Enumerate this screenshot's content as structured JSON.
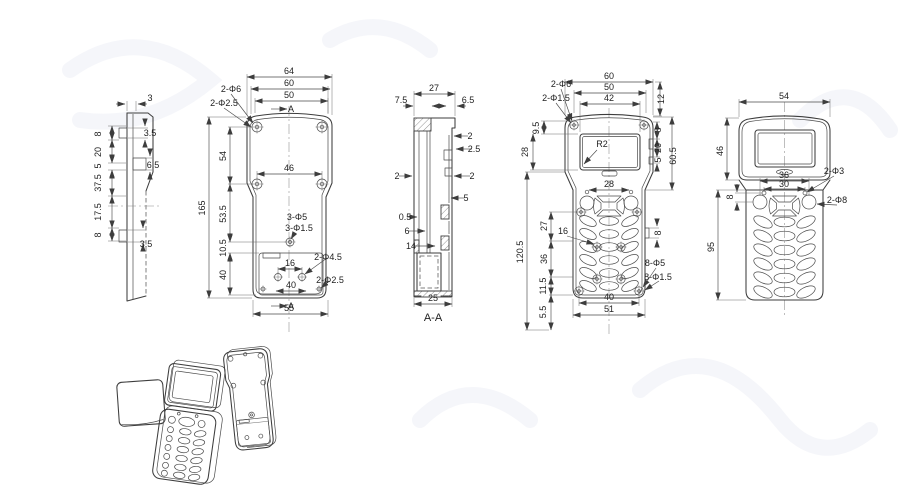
{
  "drawing": {
    "side_view": {
      "w_top": "3",
      "seg1": "8",
      "seg2": "20",
      "seg3": "5",
      "seg4": "37.5",
      "seg5": "17.5",
      "seg6": "8",
      "tab_top": "3.5",
      "step": "6.5",
      "tab_bottom": "3.5"
    },
    "back_view": {
      "w_outer": "64",
      "w_screws": "60",
      "w_opening": "50",
      "section_label_top": "A",
      "section_label_bottom": "A",
      "h_total": "165",
      "h_upper": "54",
      "h_mid": "53.5",
      "h_hole": "10.5",
      "h_box": "40",
      "w_mid_bosses": "46",
      "corner_holes": "2-Φ6",
      "corner_holes2": "2-Φ2.5",
      "center_holes": "3-Φ5",
      "center_holes2": "3-Φ1.5",
      "box_holes": "2-Φ4.5",
      "box_corner_holes": "2-Φ2.5",
      "w_hole_pair": "16",
      "w_hole_pair2": "40",
      "w_bottom": "55"
    },
    "section_view": {
      "w_top": "27",
      "lip_left": "7.5",
      "lip_right": "6.5",
      "wall1": "2",
      "wall2": "2.5",
      "wall3": "2",
      "wall4": "2",
      "boss_w": "5",
      "gap": "0.5",
      "rib": "6",
      "box_w": "14",
      "w_bottom": "25",
      "caption": "A-A"
    },
    "front_view": {
      "w_outer": "60",
      "w_screws": "50",
      "w_window": "42",
      "h_top_right": "12",
      "corner_holes": "2-Φ6",
      "corner_holes2": "2-Φ1.5",
      "h_window_top": "9.5",
      "h_window": "28",
      "rc1": "8",
      "rc2": "20",
      "rc3": "5",
      "h_bezel": "60.5",
      "corner_radius": "R2",
      "w_top_holes": "28",
      "h_keypad": "120.5",
      "k1": "27",
      "k2": "16",
      "k3": "36",
      "k4": "11.5",
      "k5": "5.5",
      "notch": "8",
      "boss_holes": "8-Φ5",
      "boss_holes2": "8-Φ1.5",
      "w_bosses": "40",
      "w_bottom": "51"
    },
    "assembled_view": {
      "w_top": "54",
      "h_screen": "46",
      "w_holes": "36",
      "w_holes2": "30",
      "h_offset": "8",
      "h_body": "95",
      "small_holes": "2-Φ3",
      "big_holes": "2-Φ8"
    }
  }
}
